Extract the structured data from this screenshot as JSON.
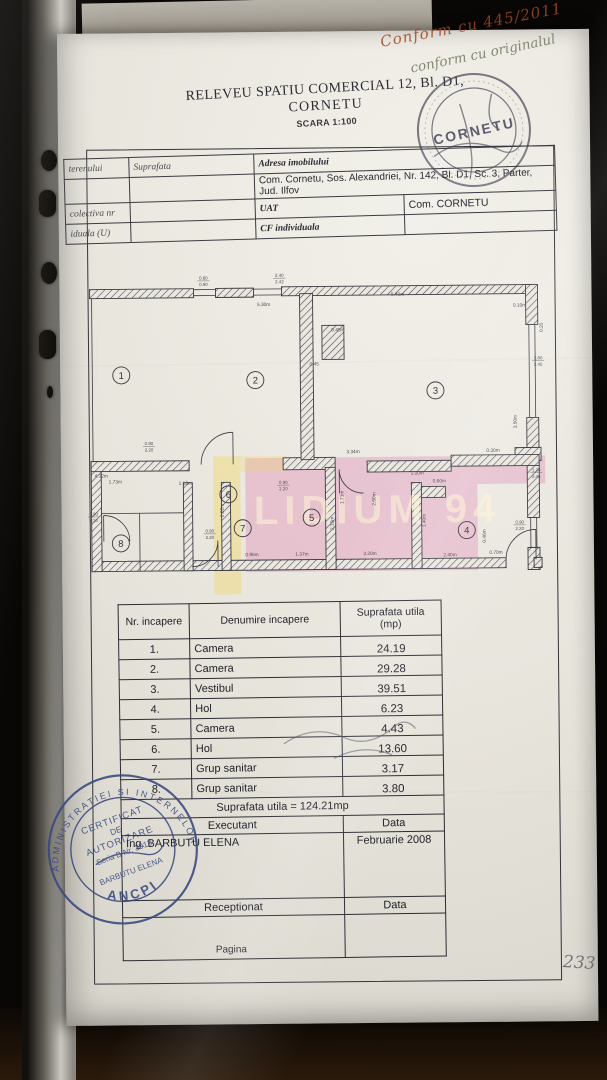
{
  "document": {
    "title_line1": "RELEVEU SPATIU COMERCIAL 12, Bl. D1,",
    "title_line2": "CORNETU",
    "scale": "SCARA 1:100"
  },
  "annotations": {
    "handwriting_line1": "Conform cu 445/2011",
    "handwriting_line2": "conform cu originalul",
    "page_number": "233"
  },
  "top_stamp": {
    "center_text": "CORNETU"
  },
  "header_table": {
    "col1_rows": [
      "terenului",
      "",
      "colectiva nr",
      "iduala (U)"
    ],
    "suprafata_label": "Suprafata",
    "adresa_label": "Adresa imobilului",
    "adresa_value": "Com. Cornetu, Sos. Alexandriei, Nr. 142, Bl. D1, Sc. 3, Parter, Jud. Ilfov",
    "uat_label": "UAT",
    "uat_value": "Com. CORNETU",
    "cf_label": "CF individuala"
  },
  "plan": {
    "watermark": "LIDIUM 94",
    "highlight_pink": "#e07ab0",
    "highlight_yellow": "#f0d664",
    "rooms": [
      {
        "n": "1",
        "x": 35,
        "y": 102
      },
      {
        "n": "2",
        "x": 169,
        "y": 108
      },
      {
        "n": "3",
        "x": 349,
        "y": 120
      },
      {
        "n": "4",
        "x": 379,
        "y": 260
      },
      {
        "n": "5",
        "x": 224,
        "y": 246
      },
      {
        "n": "6",
        "x": 141,
        "y": 222
      },
      {
        "n": "7",
        "x": 155,
        "y": 256
      },
      {
        "n": "8",
        "x": 33,
        "y": 270
      }
    ],
    "dims": [
      {
        "t": "5.30m",
        "x": 178,
        "y": 34,
        "r": 0
      },
      {
        "t": "5.40m",
        "x": 312,
        "y": 25,
        "r": 0
      },
      {
        "t": "0.60/0.90",
        "x": 118,
        "y": 7,
        "r": 0
      },
      {
        "t": "2.40/2.42",
        "x": 194,
        "y": 5,
        "r": 0
      },
      {
        "t": "0.45m",
        "x": 252,
        "y": 60,
        "r": 0
      },
      {
        "t": "0.45",
        "x": 228,
        "y": 94,
        "r": 0
      },
      {
        "t": "0.10m",
        "x": 434,
        "y": 37,
        "r": 0
      },
      {
        "t": "0.20",
        "x": 457,
        "y": 58,
        "r": -90
      },
      {
        "t": "2.80/2.45",
        "x": 452,
        "y": 90,
        "r": 0
      },
      {
        "t": "3.50m",
        "x": 430,
        "y": 152,
        "r": -90
      },
      {
        "t": "0.30m",
        "x": 406,
        "y": 182,
        "r": 0
      },
      {
        "t": "1.20/2.45",
        "x": 449,
        "y": 202,
        "r": 0
      },
      {
        "t": "3.34m",
        "x": 266,
        "y": 182,
        "r": 0
      },
      {
        "t": "4.32m",
        "x": 14,
        "y": 204,
        "r": 0
      },
      {
        "t": "0.90/2.20",
        "x": 62,
        "y": 172,
        "r": 0
      },
      {
        "t": "0.90/2.20",
        "x": 6,
        "y": 242,
        "r": 0
      },
      {
        "t": "0.90/2.20",
        "x": 122,
        "y": 260,
        "r": 0
      },
      {
        "t": "0.90/2.20",
        "x": 196,
        "y": 212,
        "r": 0
      },
      {
        "t": "0.90/2.20",
        "x": 432,
        "y": 254,
        "r": 0
      },
      {
        "t": "1.00m",
        "x": 330,
        "y": 204,
        "r": 0
      },
      {
        "t": "1.12m",
        "x": 98,
        "y": 212,
        "r": 0
      },
      {
        "t": "1.73m",
        "x": 28,
        "y": 210,
        "r": 0
      },
      {
        "t": "0.96m",
        "x": 164,
        "y": 284,
        "r": 0
      },
      {
        "t": "1.37m",
        "x": 214,
        "y": 284,
        "r": 0
      },
      {
        "t": "3.20m",
        "x": 282,
        "y": 284,
        "r": 0
      },
      {
        "t": "2.40m",
        "x": 362,
        "y": 286,
        "r": 0
      },
      {
        "t": "0.70m",
        "x": 408,
        "y": 284,
        "r": 0
      },
      {
        "t": "0.60m",
        "x": 352,
        "y": 212,
        "r": 0
      },
      {
        "t": "2.82m",
        "x": 136,
        "y": 238,
        "r": -90
      },
      {
        "t": "2.15m",
        "x": 246,
        "y": 252,
        "r": -90
      },
      {
        "t": "1.71m",
        "x": 256,
        "y": 226,
        "r": -90
      },
      {
        "t": "2.60m",
        "x": 288,
        "y": 228,
        "r": -90
      },
      {
        "t": "1.40m",
        "x": 338,
        "y": 250,
        "r": -90
      },
      {
        "t": "0.46m",
        "x": 398,
        "y": 266,
        "r": -90
      }
    ]
  },
  "room_table": {
    "header_nr": "Nr. incapere",
    "header_name": "Denumire incapere",
    "header_area_1": "Suprafata utila",
    "header_area_2": "(mp)",
    "rows": [
      {
        "nr": "1.",
        "name": "Camera",
        "area": "24.19"
      },
      {
        "nr": "2.",
        "name": "Camera",
        "area": "29.28"
      },
      {
        "nr": "3.",
        "name": "Vestibul",
        "area": "39.51"
      },
      {
        "nr": "4.",
        "name": "Hol",
        "area": "6.23"
      },
      {
        "nr": "5.",
        "name": "Camera",
        "area": "4.43"
      },
      {
        "nr": "6.",
        "name": "Hol",
        "area": "13.60"
      },
      {
        "nr": "7.",
        "name": "Grup sanitar",
        "area": "3.17"
      },
      {
        "nr": "8.",
        "name": "Grup sanitar",
        "area": "3.80"
      }
    ],
    "total": "Suprafata utila = 124.21mp",
    "executant_label": "Executant",
    "data_label": "Data",
    "executant_name": "Ing. BARBUTU ELENA",
    "date_value": "Februarie 2008",
    "receptionat_label": "Receptionat",
    "data_label2": "Data",
    "pagina_label": "Pagina"
  },
  "bottom_stamp": {
    "arc_top": "ADMINISTRATIEI SI INTERNELOR",
    "arc_bottom": "ANCPI",
    "line1": "CERTIFICAT",
    "line2": "DE",
    "line3": "AUTORIZARE",
    "line4": "Seria B Nr. 3913",
    "line5": "BARBUTU ELENA"
  }
}
